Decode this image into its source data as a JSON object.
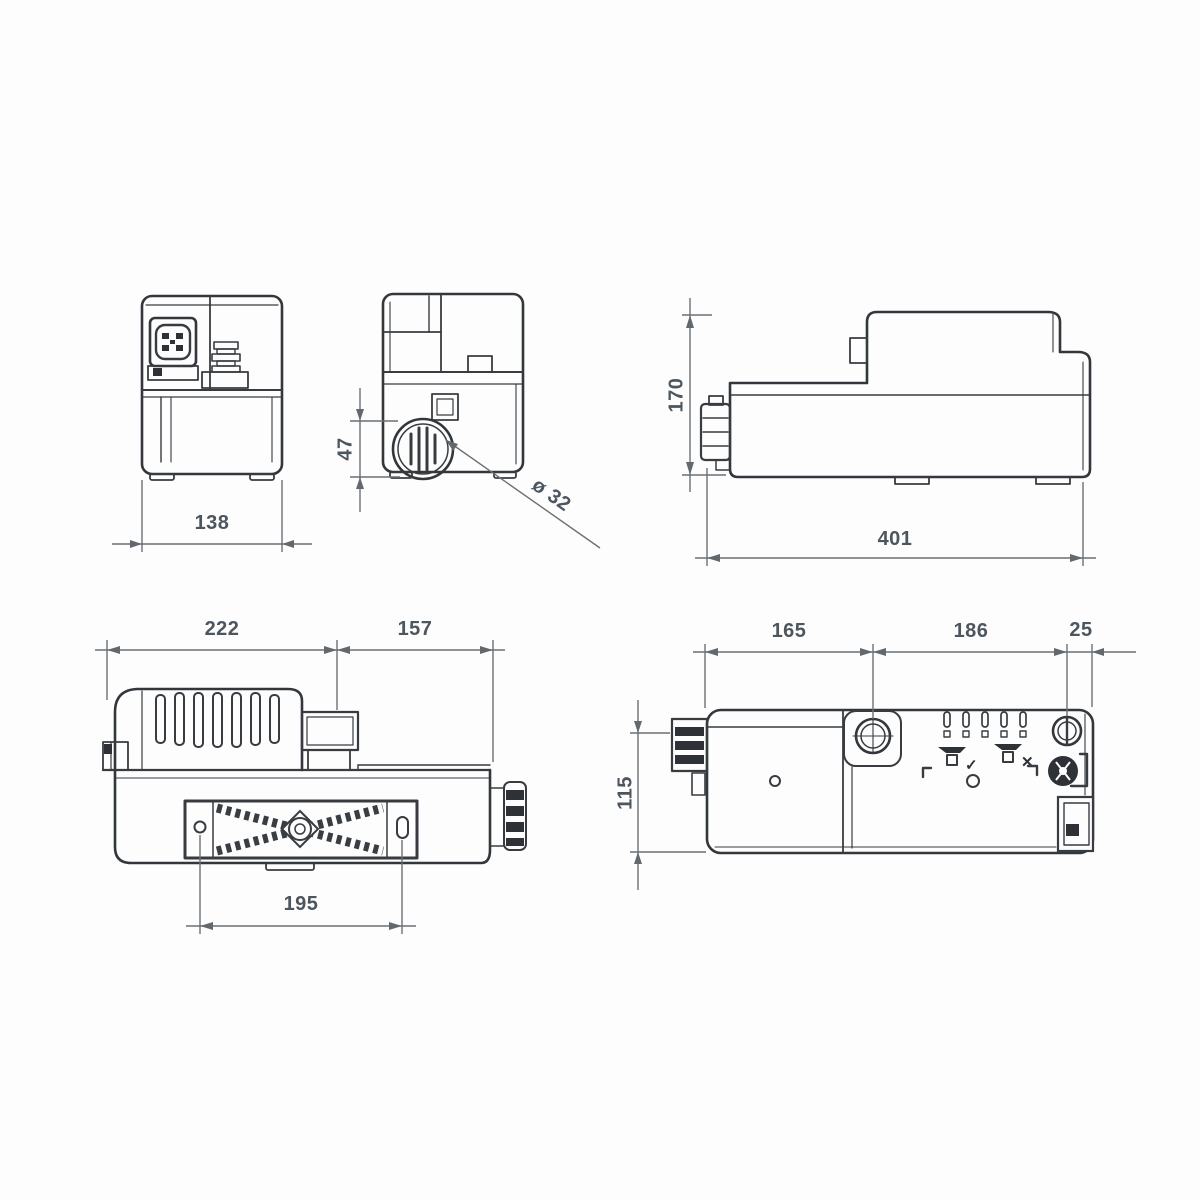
{
  "document": {
    "kind": "technical-dimension-drawing",
    "subject": "condensate-pump-five-orthographic-views"
  },
  "colors": {
    "background": "#fdfdfd",
    "object_line": "#383c40",
    "dimension_line": "#6b7075",
    "dimension_text": "#4d565e",
    "dark_fill": "#2e3236"
  },
  "views": {
    "end_power": {
      "width": "138"
    },
    "end_inlet": {
      "inlet_span": "47",
      "inlet_diameter": "ø 32"
    },
    "side": {
      "height": "170",
      "length": "401"
    },
    "side_motor": {
      "motor_length": "222",
      "tank_length": "157",
      "hole_spacing": "195"
    },
    "top": {
      "inlet_center": "165",
      "inlet_to_screw": "186",
      "screw_to_edge": "25",
      "depth": "115"
    }
  },
  "icons": {
    "tool_allowed_check": "✓",
    "tool_forbidden_cross": "✕",
    "names": "power-connector-icon, hose-barb-icon, inlet-grille-icon, hand-tool-check-icon, hand-tool-cross-icon, screw-cap-icon, knurled-knob-icon, mounting-plate-cross-brace"
  }
}
